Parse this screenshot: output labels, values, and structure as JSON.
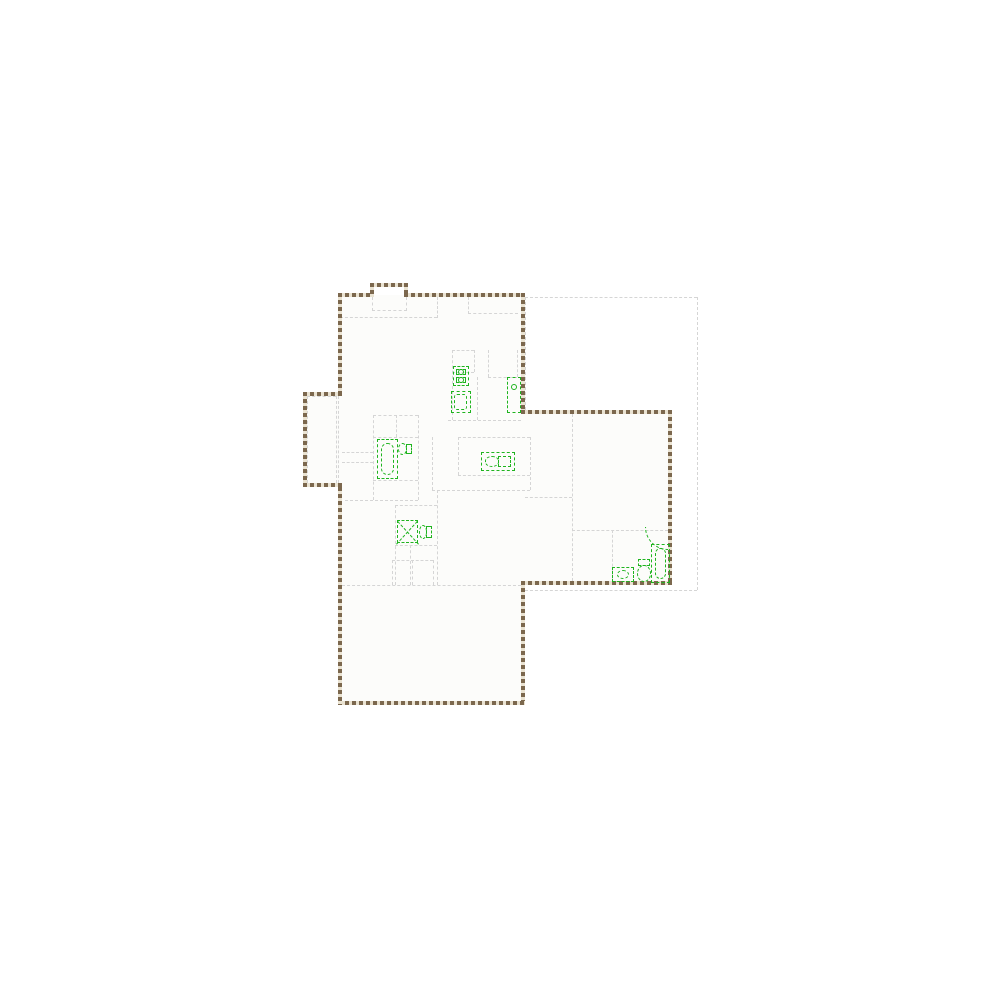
{
  "canvas": {
    "width": 1000,
    "height": 1000,
    "background": "#ffffff"
  },
  "palette": {
    "wall_dark": "#7c684e",
    "wall_light": "#eae3d2",
    "partition": "#d5d5d5",
    "fixture_green": "#1fb41f",
    "floor": "#fcfcfa"
  },
  "floorplan": {
    "floor_fills": [
      [
        340,
        295,
        183,
        408
      ],
      [
        523,
        412,
        147,
        171
      ],
      [
        305,
        394,
        35,
        91
      ]
    ],
    "walls": [
      [
        338,
        293,
        36,
        4
      ],
      [
        370,
        283,
        4,
        14
      ],
      [
        370,
        283,
        38,
        4
      ],
      [
        404,
        283,
        4,
        14
      ],
      [
        404,
        293,
        121,
        4
      ],
      [
        521,
        293,
        4,
        121
      ],
      [
        521,
        410,
        151,
        4
      ],
      [
        668,
        410,
        4,
        175
      ],
      [
        521,
        581,
        151,
        4
      ],
      [
        521,
        581,
        4,
        124
      ],
      [
        338,
        701,
        187,
        4
      ],
      [
        338,
        487,
        4,
        218
      ],
      [
        338,
        293,
        4,
        103
      ],
      [
        303,
        392,
        39,
        4
      ],
      [
        303,
        392,
        4,
        95
      ],
      [
        303,
        483,
        39,
        4
      ]
    ],
    "partitions": [
      [
        340,
        317,
        97,
        1
      ],
      [
        437,
        297,
        1,
        21
      ],
      [
        372,
        297,
        1,
        14
      ],
      [
        406,
        297,
        1,
        14
      ],
      [
        372,
        310,
        35,
        1
      ],
      [
        468,
        313,
        50,
        1
      ],
      [
        468,
        297,
        1,
        17
      ],
      [
        452,
        350,
        1,
        70
      ],
      [
        452,
        350,
        22,
        1
      ],
      [
        474,
        350,
        1,
        22
      ],
      [
        452,
        372,
        22,
        1
      ],
      [
        448,
        420,
        73,
        1
      ],
      [
        477,
        377,
        1,
        43
      ],
      [
        488,
        350,
        1,
        27
      ],
      [
        488,
        377,
        29,
        1
      ],
      [
        517,
        350,
        1,
        27
      ],
      [
        432,
        437,
        1,
        53
      ],
      [
        458,
        437,
        72,
        1
      ],
      [
        458,
        437,
        1,
        38
      ],
      [
        458,
        475,
        72,
        1
      ],
      [
        530,
        437,
        1,
        53
      ],
      [
        432,
        490,
        98,
        1
      ],
      [
        373,
        415,
        1,
        85
      ],
      [
        418,
        415,
        1,
        85
      ],
      [
        373,
        415,
        45,
        1
      ],
      [
        373,
        437,
        45,
        1
      ],
      [
        396,
        415,
        1,
        22
      ],
      [
        345,
        500,
        73,
        1
      ],
      [
        373,
        480,
        45,
        1
      ],
      [
        342,
        452,
        31,
        1
      ],
      [
        342,
        462,
        31,
        1
      ],
      [
        395,
        505,
        1,
        80
      ],
      [
        437,
        490,
        1,
        95
      ],
      [
        395,
        505,
        42,
        1
      ],
      [
        395,
        545,
        42,
        1
      ],
      [
        410,
        545,
        1,
        40
      ],
      [
        572,
        414,
        1,
        167
      ],
      [
        525,
        497,
        47,
        1
      ],
      [
        572,
        530,
        96,
        1
      ],
      [
        612,
        530,
        1,
        51
      ],
      [
        342,
        585,
        179,
        1
      ],
      [
        392,
        560,
        41,
        1
      ],
      [
        392,
        560,
        1,
        25
      ],
      [
        412,
        560,
        1,
        25
      ],
      [
        433,
        560,
        1,
        25
      ],
      [
        525,
        297,
        172,
        1
      ],
      [
        697,
        297,
        1,
        293
      ],
      [
        525,
        590,
        172,
        1
      ],
      [
        525,
        297,
        1,
        113
      ],
      [
        338,
        396,
        1,
        87
      ],
      [
        307,
        396,
        29,
        1
      ],
      [
        307,
        396,
        1,
        87
      ],
      [
        307,
        483,
        29,
        1
      ],
      [
        336,
        396,
        1,
        87
      ]
    ],
    "fixtures": [
      {
        "kind": "washer-dryer",
        "name": "washer-dryer",
        "rect": [
          453,
          366,
          16,
          20
        ]
      },
      {
        "kind": "laundry-sink",
        "name": "laundry-sink",
        "rect": [
          451,
          391,
          20,
          22
        ]
      },
      {
        "kind": "water-heater",
        "name": "water-heater",
        "rect": [
          507,
          377,
          14,
          36
        ]
      },
      {
        "kind": "kitchen-sink",
        "name": "kitchen-sink",
        "rect": [
          481,
          452,
          34,
          19
        ]
      },
      {
        "kind": "bathtub",
        "name": "bathtub-left",
        "rect": [
          377,
          439,
          21,
          40
        ]
      },
      {
        "kind": "toilet-h",
        "name": "toilet-left",
        "rect": [
          398,
          442,
          14,
          14
        ]
      },
      {
        "kind": "shower-x",
        "name": "shower-stall",
        "rect": [
          397,
          520,
          21,
          23
        ]
      },
      {
        "kind": "toilet-h",
        "name": "toilet-center",
        "rect": [
          419,
          524,
          13,
          16
        ]
      },
      {
        "kind": "vanity",
        "name": "vanity-right",
        "rect": [
          612,
          567,
          22,
          15
        ]
      },
      {
        "kind": "toilet-v",
        "name": "toilet-right",
        "rect": [
          636,
          559,
          16,
          23
        ]
      },
      {
        "kind": "bathtub",
        "name": "bathtub-right",
        "rect": [
          651,
          544,
          19,
          39
        ]
      },
      {
        "kind": "shower-arc",
        "name": "shower-corner",
        "rect": [
          645,
          527,
          23,
          23
        ]
      }
    ]
  }
}
